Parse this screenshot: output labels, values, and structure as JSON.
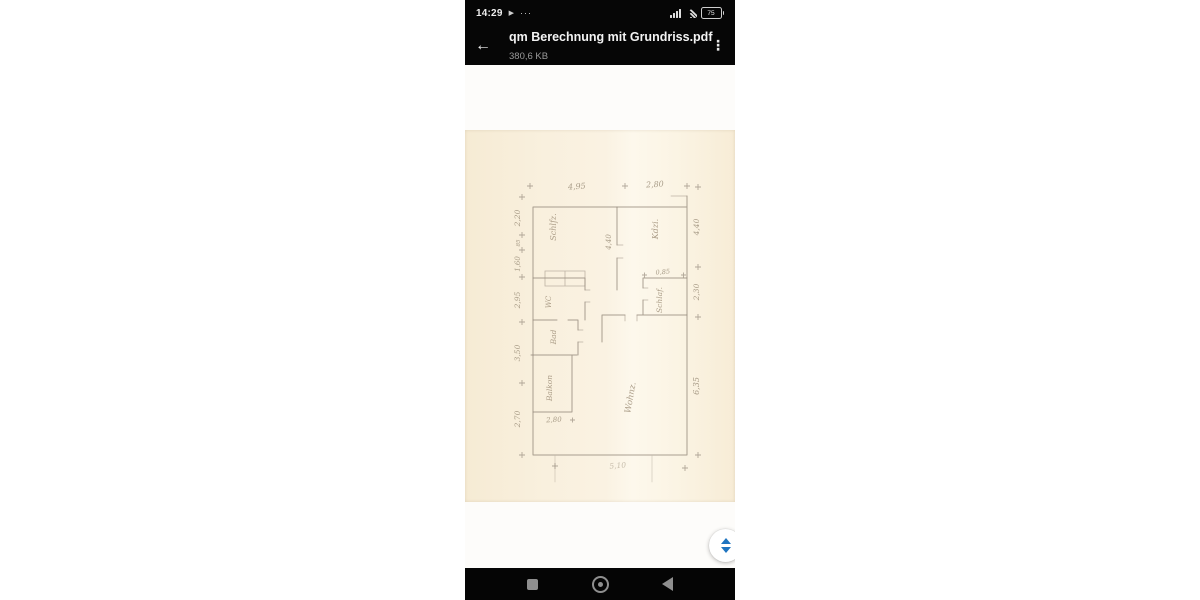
{
  "status_bar": {
    "time": "14:29",
    "play_icon": "▶",
    "more_icon": "···",
    "battery_percent": "75"
  },
  "app_bar": {
    "back_icon": "←",
    "title": "qm Berechnung mit Grundriss.pdf",
    "subtitle": "380,6 KB",
    "menu_icon": "⋮"
  },
  "document": {
    "kind": "scanned handwritten floor-plan sketch (qm Berechnung / Grundriss)",
    "plan": {
      "rooms": {
        "schlafzimmer": "Schlfz.",
        "kinderzimmer": "Kdzi.",
        "schlaf": "Schlaf.",
        "wc": "WC",
        "bad": "Bad",
        "balkon": "Balkon",
        "wohnzimmer": "Wohnz."
      },
      "dims": {
        "top_a": "4,95",
        "top_b": "2,80",
        "left_a": "2,20",
        "left_b": "85",
        "left_c": "1,60",
        "left_d": "2,95",
        "left_e": "3,50",
        "left_f": "2,70",
        "right_a": "4,40",
        "right_b": "2,30",
        "right_c": "6,35",
        "inner_a": "4,40",
        "inner_b": "0,85",
        "balkon_w": "2,80",
        "bottom": "5,10"
      }
    }
  },
  "colors": {
    "header_bg": "#060606",
    "paper": "#f9f0de",
    "pencil": "#93887a",
    "scroll_arrows": "#1f74c0"
  }
}
